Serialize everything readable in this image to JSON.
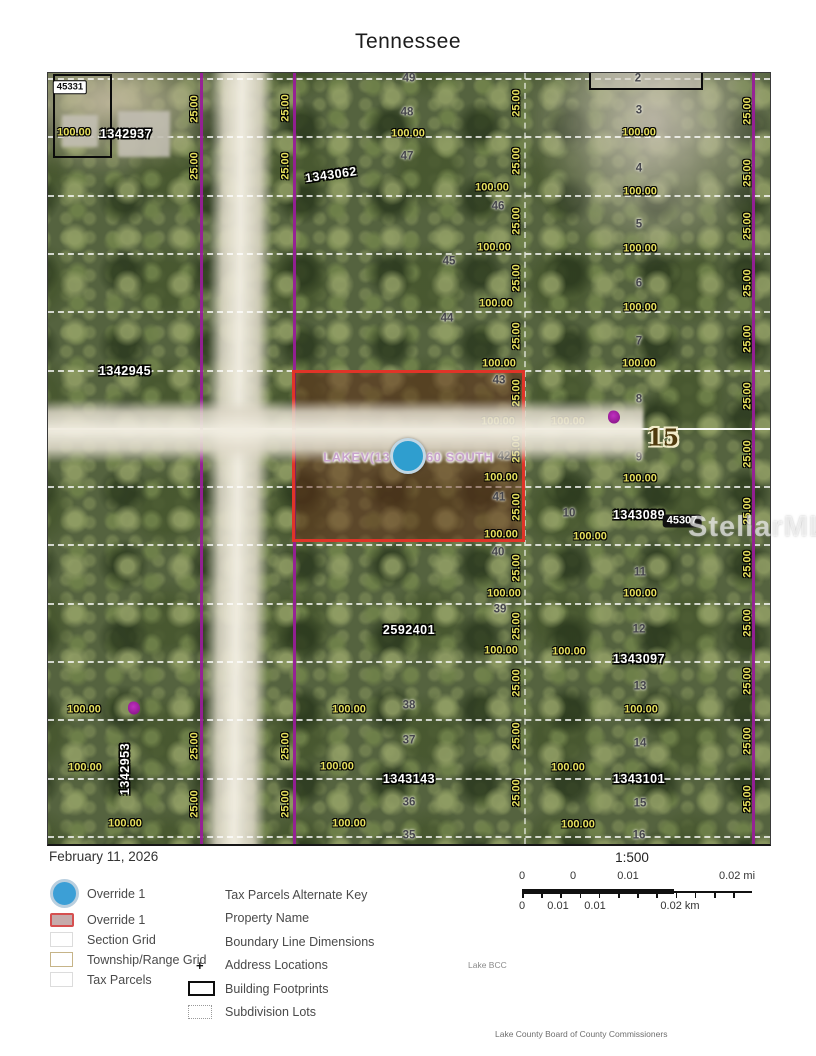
{
  "title": "Tennessee",
  "date": "February 11, 2026",
  "watermark": "StellarMLS",
  "lake_bcc": "Lake BCC",
  "attribution": "Lake County Board of County Commissioners",
  "colors": {
    "township_grid_purple": "#981d98",
    "override_red": "#e03428",
    "override_blue": "#3c9fd6",
    "dimension_yellow": "#e8e15e"
  },
  "scale": {
    "ratio": "1:500",
    "mi_ticks": [
      "0",
      "0",
      "0.01",
      "0.02 mi"
    ],
    "km_ticks": [
      "0",
      "0.01",
      "0.01",
      "0.02 km"
    ]
  },
  "legend": {
    "left": [
      {
        "label": "Override 1",
        "swatch": "circle-blue"
      },
      {
        "label": "Override 1",
        "swatch": "rect-red"
      },
      {
        "label": "Section Grid",
        "swatch": "rect-plain"
      },
      {
        "label": "Township/Range Grid",
        "swatch": "rect-tan"
      },
      {
        "label": "Tax Parcels",
        "swatch": "rect-plain"
      }
    ],
    "right": [
      {
        "label": "Tax Parcels Alternate Key",
        "marker": "none"
      },
      {
        "label": "Property Name",
        "marker": "none"
      },
      {
        "label": "Boundary Line Dimensions",
        "marker": "none"
      },
      {
        "label": "Address Locations",
        "marker": "plus"
      },
      {
        "label": "Building Footprints",
        "marker": "rect-black"
      },
      {
        "label": "Subdivision Lots",
        "marker": "rect-dotted"
      }
    ]
  },
  "map": {
    "street_label": "TENNESSEE  ST",
    "property_name": "LAKEV(13 ... 60 SOUTH",
    "section_number": "15",
    "labels": [
      {
        "t": "49",
        "x": 361,
        "y": 6,
        "s": "lot"
      },
      {
        "t": "48",
        "x": 359,
        "y": 40,
        "s": "lot"
      },
      {
        "t": "47",
        "x": 359,
        "y": 84,
        "s": "lot"
      },
      {
        "t": "46",
        "x": 450,
        "y": 134,
        "s": "lot"
      },
      {
        "t": "45",
        "x": 401,
        "y": 189,
        "s": "lot"
      },
      {
        "t": "44",
        "x": 399,
        "y": 246,
        "s": "lot"
      },
      {
        "t": "43",
        "x": 451,
        "y": 308,
        "s": "lot"
      },
      {
        "t": "42",
        "x": 456,
        "y": 384,
        "s": "lot"
      },
      {
        "t": "41",
        "x": 451,
        "y": 425,
        "s": "lot"
      },
      {
        "t": "40",
        "x": 450,
        "y": 480,
        "s": "lot"
      },
      {
        "t": "39",
        "x": 452,
        "y": 537,
        "s": "lot"
      },
      {
        "t": "38",
        "x": 361,
        "y": 633,
        "s": "lot"
      },
      {
        "t": "37",
        "x": 361,
        "y": 668,
        "s": "lot"
      },
      {
        "t": "36",
        "x": 361,
        "y": 730,
        "s": "lot"
      },
      {
        "t": "35",
        "x": 361,
        "y": 763,
        "s": "lot"
      },
      {
        "t": "2",
        "x": 590,
        "y": 6,
        "s": "lot"
      },
      {
        "t": "3",
        "x": 591,
        "y": 38,
        "s": "lot"
      },
      {
        "t": "4",
        "x": 591,
        "y": 96,
        "s": "lot"
      },
      {
        "t": "5",
        "x": 591,
        "y": 152,
        "s": "lot"
      },
      {
        "t": "6",
        "x": 591,
        "y": 211,
        "s": "lot"
      },
      {
        "t": "7",
        "x": 591,
        "y": 269,
        "s": "lot"
      },
      {
        "t": "8",
        "x": 591,
        "y": 327,
        "s": "lot"
      },
      {
        "t": "9",
        "x": 591,
        "y": 385,
        "s": "lot"
      },
      {
        "t": "10",
        "x": 521,
        "y": 441,
        "s": "lot"
      },
      {
        "t": "11",
        "x": 592,
        "y": 500,
        "s": "lot"
      },
      {
        "t": "12",
        "x": 591,
        "y": 557,
        "s": "lot"
      },
      {
        "t": "13",
        "x": 592,
        "y": 614,
        "s": "lot"
      },
      {
        "t": "14",
        "x": 592,
        "y": 671,
        "s": "lot"
      },
      {
        "t": "15",
        "x": 592,
        "y": 731,
        "s": "lot"
      },
      {
        "t": "16",
        "x": 591,
        "y": 763,
        "s": "lot"
      },
      {
        "t": "100.00",
        "x": 26,
        "y": 60,
        "s": "dim"
      },
      {
        "t": "100.00",
        "x": 360,
        "y": 61,
        "s": "dim"
      },
      {
        "t": "100.00",
        "x": 444,
        "y": 115,
        "s": "dim"
      },
      {
        "t": "100.00",
        "x": 446,
        "y": 175,
        "s": "dim"
      },
      {
        "t": "100.00",
        "x": 448,
        "y": 231,
        "s": "dim"
      },
      {
        "t": "100.00",
        "x": 451,
        "y": 291,
        "s": "dim"
      },
      {
        "t": "100.00",
        "x": 450,
        "y": 349,
        "s": "dim"
      },
      {
        "t": "100.00",
        "x": 453,
        "y": 405,
        "s": "dim"
      },
      {
        "t": "100.00",
        "x": 453,
        "y": 462,
        "s": "dim"
      },
      {
        "t": "100.00",
        "x": 456,
        "y": 521,
        "s": "dim"
      },
      {
        "t": "100.00",
        "x": 453,
        "y": 578,
        "s": "dim"
      },
      {
        "t": "100.00",
        "x": 301,
        "y": 637,
        "s": "dim"
      },
      {
        "t": "100.00",
        "x": 289,
        "y": 694,
        "s": "dim"
      },
      {
        "t": "100.00",
        "x": 301,
        "y": 751,
        "s": "dim"
      },
      {
        "t": "100.00",
        "x": 591,
        "y": 60,
        "s": "dim"
      },
      {
        "t": "100.00",
        "x": 592,
        "y": 119,
        "s": "dim"
      },
      {
        "t": "100.00",
        "x": 592,
        "y": 176,
        "s": "dim"
      },
      {
        "t": "100.00",
        "x": 592,
        "y": 235,
        "s": "dim"
      },
      {
        "t": "100.00",
        "x": 591,
        "y": 291,
        "s": "dim"
      },
      {
        "t": "100.00",
        "x": 520,
        "y": 349,
        "s": "dim"
      },
      {
        "t": "100.00",
        "x": 592,
        "y": 406,
        "s": "dim"
      },
      {
        "t": "100.00",
        "x": 542,
        "y": 464,
        "s": "dim"
      },
      {
        "t": "100.00",
        "x": 592,
        "y": 521,
        "s": "dim"
      },
      {
        "t": "100.00",
        "x": 521,
        "y": 579,
        "s": "dim"
      },
      {
        "t": "100.00",
        "x": 593,
        "y": 637,
        "s": "dim"
      },
      {
        "t": "100.00",
        "x": 520,
        "y": 695,
        "s": "dim"
      },
      {
        "t": "100.00",
        "x": 530,
        "y": 752,
        "s": "dim"
      },
      {
        "t": "100.00",
        "x": 36,
        "y": 637,
        "s": "dim"
      },
      {
        "t": "100.00",
        "x": 37,
        "y": 695,
        "s": "dim"
      },
      {
        "t": "100.00",
        "x": 77,
        "y": 751,
        "s": "dim"
      },
      {
        "t": "25.00",
        "x": 469,
        "y": 30,
        "s": "dim",
        "r": -90
      },
      {
        "t": "25.00",
        "x": 469,
        "y": 88,
        "s": "dim",
        "r": -90
      },
      {
        "t": "25.00",
        "x": 469,
        "y": 148,
        "s": "dim",
        "r": -90
      },
      {
        "t": "25.00",
        "x": 469,
        "y": 205,
        "s": "dim",
        "r": -90
      },
      {
        "t": "25.00",
        "x": 469,
        "y": 263,
        "s": "dim",
        "r": -90
      },
      {
        "t": "25.00",
        "x": 469,
        "y": 320,
        "s": "dim",
        "r": -90
      },
      {
        "t": "25.00",
        "x": 469,
        "y": 376,
        "s": "dim",
        "r": -90
      },
      {
        "t": "25.00",
        "x": 469,
        "y": 434,
        "s": "dim",
        "r": -90
      },
      {
        "t": "25.00",
        "x": 469,
        "y": 495,
        "s": "dim",
        "r": -90
      },
      {
        "t": "25.00",
        "x": 469,
        "y": 553,
        "s": "dim",
        "r": -90
      },
      {
        "t": "25.00",
        "x": 469,
        "y": 610,
        "s": "dim",
        "r": -90
      },
      {
        "t": "25.00",
        "x": 469,
        "y": 663,
        "s": "dim",
        "r": -90
      },
      {
        "t": "25.00",
        "x": 469,
        "y": 720,
        "s": "dim",
        "r": -90
      },
      {
        "t": "25.00",
        "x": 700,
        "y": 38,
        "s": "dim",
        "r": -90
      },
      {
        "t": "25.00",
        "x": 700,
        "y": 100,
        "s": "dim",
        "r": -90
      },
      {
        "t": "25.00",
        "x": 700,
        "y": 153,
        "s": "dim",
        "r": -90
      },
      {
        "t": "25.00",
        "x": 700,
        "y": 210,
        "s": "dim",
        "r": -90
      },
      {
        "t": "25.00",
        "x": 700,
        "y": 266,
        "s": "dim",
        "r": -90
      },
      {
        "t": "25.00",
        "x": 700,
        "y": 323,
        "s": "dim",
        "r": -90
      },
      {
        "t": "25.00",
        "x": 700,
        "y": 381,
        "s": "dim",
        "r": -90
      },
      {
        "t": "25.00",
        "x": 700,
        "y": 438,
        "s": "dim",
        "r": -90
      },
      {
        "t": "25.00",
        "x": 700,
        "y": 491,
        "s": "dim",
        "r": -90
      },
      {
        "t": "25.00",
        "x": 700,
        "y": 550,
        "s": "dim",
        "r": -90
      },
      {
        "t": "25.00",
        "x": 700,
        "y": 608,
        "s": "dim",
        "r": -90
      },
      {
        "t": "25.00",
        "x": 700,
        "y": 668,
        "s": "dim",
        "r": -90
      },
      {
        "t": "25.00",
        "x": 700,
        "y": 726,
        "s": "dim",
        "r": -90
      },
      {
        "t": "25.00",
        "x": 147,
        "y": 36,
        "s": "dim",
        "r": -90
      },
      {
        "t": "25.00",
        "x": 147,
        "y": 93,
        "s": "dim",
        "r": -90
      },
      {
        "t": "25.00",
        "x": 147,
        "y": 673,
        "s": "dim",
        "r": -90
      },
      {
        "t": "25.00",
        "x": 147,
        "y": 731,
        "s": "dim",
        "r": -90
      },
      {
        "t": "25.00",
        "x": 238,
        "y": 35,
        "s": "dim",
        "r": -90
      },
      {
        "t": "25.00",
        "x": 238,
        "y": 93,
        "s": "dim",
        "r": -90
      },
      {
        "t": "25.00",
        "x": 238,
        "y": 673,
        "s": "dim",
        "r": -90
      },
      {
        "t": "25.00",
        "x": 238,
        "y": 731,
        "s": "dim",
        "r": -90
      },
      {
        "t": "1342937",
        "x": 78,
        "y": 61,
        "s": "pid"
      },
      {
        "t": "1343062",
        "x": 283,
        "y": 102,
        "s": "pid",
        "r": -8
      },
      {
        "t": "1342945",
        "x": 77,
        "y": 298,
        "s": "pid"
      },
      {
        "t": "1343089",
        "x": 591,
        "y": 442,
        "s": "pid"
      },
      {
        "t": "2592401",
        "x": 361,
        "y": 557,
        "s": "pid"
      },
      {
        "t": "1343097",
        "x": 591,
        "y": 586,
        "s": "pid"
      },
      {
        "t": "1343143",
        "x": 361,
        "y": 706,
        "s": "pid"
      },
      {
        "t": "1343101",
        "x": 591,
        "y": 706,
        "s": "pid"
      },
      {
        "t": "1342953",
        "x": 77,
        "y": 696,
        "s": "pid",
        "r": -90
      },
      {
        "t": "45331",
        "x": 22,
        "y": 14,
        "s": "chip"
      },
      {
        "t": "45307",
        "x": 634,
        "y": 448,
        "s": "chipd"
      },
      {
        "t": "15",
        "x": 615,
        "y": 365,
        "s": "sec",
        "n": "section-number"
      },
      {
        "t": "TENNESSEE  ST",
        "x": 203,
        "y": 358,
        "s": "street",
        "r": -90,
        "n": "street-label"
      },
      {
        "t": "LAKEV(13",
        "x": 342,
        "y": 384,
        "s": "pnl",
        "n": "property-name-left"
      },
      {
        "t": "60 SOUTH",
        "x": 378,
        "y": 384,
        "s": "pnr",
        "n": "property-name-right"
      },
      {
        "t": "",
        "x": 566,
        "y": 344,
        "s": "pmark",
        "n": "purple-mark"
      },
      {
        "t": "",
        "x": 86,
        "y": 635,
        "s": "pmark",
        "n": "purple-mark"
      }
    ]
  }
}
